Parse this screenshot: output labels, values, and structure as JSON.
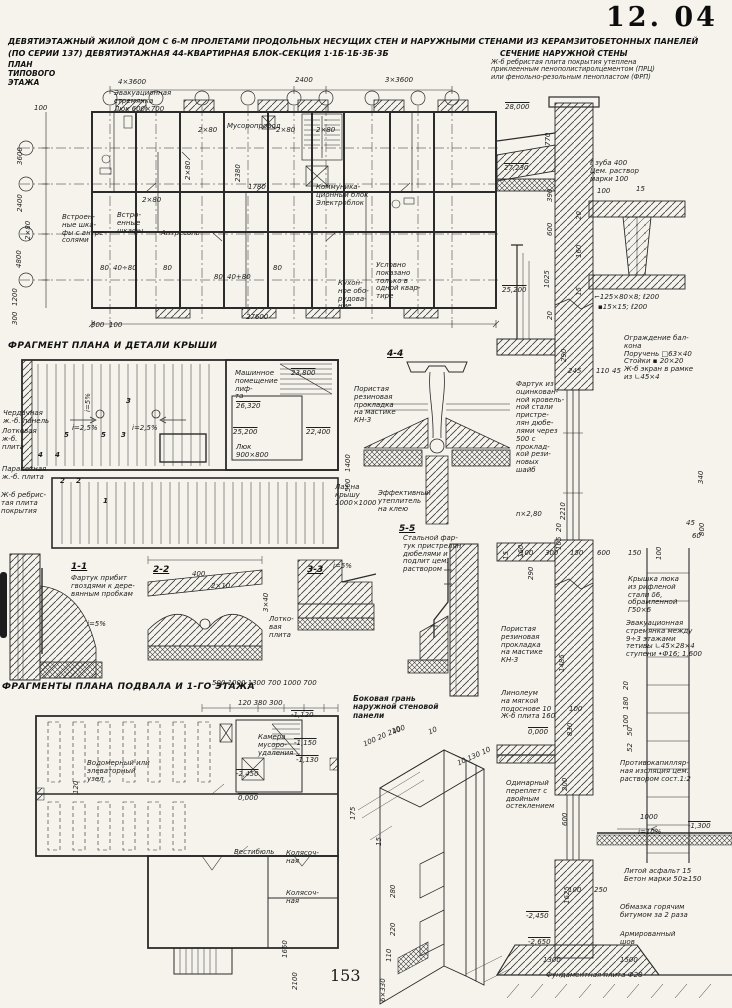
{
  "page": {
    "code": "12. 04",
    "number": "153"
  },
  "title": {
    "line1": "ДЕВЯТИЭТАЖНЫЙ ЖИЛОЙ ДОМ С 6-М ПРОЛЕТАМИ ПРОДОЛЬНЫХ НЕСУЩИХ СТЕН И НАРУЖНЫМИ СТЕНАМИ ИЗ КЕРАМЗИТОБЕТОННЫХ ПАНЕЛЕЙ",
    "line2": "(ПО СЕРИИ 137)   ДЕВЯТИЭТАЖНАЯ 44-КВАРТИРНАЯ БЛОК-СЕКЦИЯ 1·1Б·1Б·3Б·3Б"
  },
  "typical_plan": {
    "heading": "ПЛАН\nТИПОВОГО\nЭТАЖА",
    "labels": {
      "evac": "Эвакуационная\nстремянка\nЛюк 600×700",
      "chute": "Мусоропровод",
      "comm": "Коммуника-\nционный блок\nЭлектроблок",
      "wardrobe_mezz": "Встроен-\nные шка-\nфы с антре-\nсолями",
      "wardrobe": "Встро-\nенные\nшкафы",
      "mezzanine": "Антресоль",
      "kitchen": "Кухон-\nное обо-\nрудова-\nние",
      "note": "Условно\nпоказано\nтолько в\nодной квар-\nтире"
    },
    "dims": {
      "bay1": "4×3600",
      "bay2": "2400",
      "bay3": "3×3600",
      "total": "27600",
      "v3600": "3600",
      "v2400": "2400",
      "v4800": "4800",
      "v1200": "1200",
      "v300": "300",
      "w2x80": "2×80",
      "w80": "80",
      "w4080a": "40÷80",
      "w4080b": "40+80",
      "d2380": "2380",
      "d1780": "1780",
      "d300": "300",
      "d100": "100"
    }
  },
  "roof": {
    "heading": "ФРАГМЕНТ ПЛАНА И ДЕТАЛИ КРЫШИ",
    "labels": {
      "attic_panel": "Чердачная\nж.-б. панель",
      "tray_slab": "Лотковая\nж-б.\nплита",
      "parapet": "Парапетная\nж.-б. плита",
      "ribbed": "Ж-б ребрис-\nтая плита\nпокрытия",
      "machine_room": "Машинное\nпомещение\nлиф-\nта",
      "hatch": "Люк\n900×800",
      "roof_access": "Лаз на\nкрышу\n1000×1000",
      "insulation": "Эффективный\nутеплитель\nна клею"
    },
    "elevations": {
      "e1": "23,800",
      "e2": "26,320",
      "e3": "25,200",
      "e4": "22,400"
    },
    "slopes": {
      "s25": "i=2,5%",
      "s5": "i=5%"
    },
    "dims": {
      "d1400": "1400",
      "d500": "500"
    },
    "marks": {
      "m1": "1",
      "m2": "2",
      "m3": "3",
      "m4": "4",
      "m5": "5"
    }
  },
  "details": {
    "s44": {
      "title": "4-4",
      "gasket": "Пористая\nрезиновая\nпрокладка\nна мастике\nКН-3"
    },
    "s55": {
      "title": "5-5",
      "apron": "Стальной фар-\nтук пристрелян\nдюбелями и\nподлит цем.\nраствором"
    },
    "s11": {
      "title": "1-1",
      "note": "Фартук прибит\nгвоздями к дере-\nвянным пробкам",
      "slope": "i=5%"
    },
    "s22": {
      "title": "2-2",
      "d400": "400",
      "d2x10": "2×10",
      "d3x40": "3×40",
      "tray": "Лотко-\nвая\nплита"
    },
    "s33": {
      "title": "3-3",
      "slope": "i=5%"
    }
  },
  "basement": {
    "heading": "ФРАГМЕНТЫ ПЛАНА ПОДВАЛА И 1-ГО ЭТАЖА",
    "labels": {
      "water": "Водомерный или\nэлеваторный\nузел",
      "refuse": "Камера\nмусоро-\nудаления",
      "lobby": "Вестибюль",
      "pram1": "Колясоч-\nная",
      "pram2": "Колясоч-\nная"
    },
    "dims": {
      "row1": "500   1000    1300    700  1000  700",
      "row2": "120    380   300",
      "v120": "120",
      "d1650": "1650",
      "d2100": "2100"
    },
    "elevations": {
      "e1": "-1,120",
      "e2": "-1,150",
      "e3": "-1,130",
      "e4": "-2,450",
      "e5": "0,000"
    }
  },
  "panel": {
    "heading": "Боковая грань\nнаружной стеновой\nпанели",
    "dims": {
      "d400": "400",
      "row": "100  20 210",
      "d10": "10",
      "row2": "10 130 10",
      "d175": "175",
      "d15": "15",
      "d280": "280",
      "d220": "220",
      "d110": "110",
      "d6x330": "6×330"
    }
  },
  "wall_section": {
    "heading": "СЕЧЕНИЕ НАРУЖНОЙ СТЕНЫ",
    "note": "Ж-б ребристая плита покрытия утеплена\nприклеенным пенополистиролцементом (ПРЦ)\nили фенольно-резольным пенопластом (ФРП)",
    "labels": {
      "tooth": "ℓ зуба 400\nЦем. раствор\nмарки 100",
      "angle1": "⌐125×80×8; ℓ200",
      "angle2": "▪15×15; ℓ200",
      "balcony": "Ограждение бал-\nкона\nПоручень □63×40\nСтойки ▪ 20×20\nЖ-б экран в рамке\nиз ∟45×4",
      "apron": "Фартук из\nоцинкован-\nной кровель-\nной стали\nпристре-\nлян дюбе-\nлями через\n500 с\nпроклад-\nкой рези-\nновых\nшайб",
      "hatch_cover": "Крышка люка\nиз рифленой\nстали δ6,\nобрамленной\nГ50×6",
      "ladder": "Эвакуационная\nстремянка между\n9÷3 этажами\nтетивы ∟45×28×4\nступени •Ф16; 1,600",
      "gasket": "Пористая\nрезиновая\nпрокладка\nна мастике\nКН-3",
      "lino": "Линолеум\nна мягкой\nподоснове 10\nЖ-б плита 160",
      "anticap": "Противокапилляр-\nная изоляция цем.\nраствором сост.1:2",
      "glazing": "Одинарный\nпереплет с\nдвойным\nостеклением",
      "asphalt": "Литой асфальт 15\nБетон марки 50≥150",
      "bitumen": "Обмазка горячим\nбитумом за 2 раза",
      "seam": "Армированный\nшов",
      "foundation": "Фундаментная плита Ф28",
      "slope": "i=10%",
      "n_floors": "n×2,80"
    },
    "elevations": {
      "e28": "28,000",
      "e2723": "27,230",
      "e252": "25,200",
      "e0": "0,000",
      "em13": "-1,300",
      "em245": "-2,450",
      "em265": "-2,650"
    },
    "dims": {
      "d770": "770",
      "d390": "390",
      "d600": "600",
      "d1025": "1025",
      "d20": "20",
      "d100": "100",
      "d15": "15",
      "d160": "160",
      "d245": "245",
      "d110": "110",
      "d45": "45",
      "d290": "290",
      "d2210": "2210",
      "d105": "105",
      "d340": "340",
      "d800": "800",
      "d60": "60",
      "d300": "300",
      "d150": "150",
      "d1485": "1485",
      "d180": "180",
      "d830": "830",
      "d200": "200",
      "d1000": "1000",
      "d1625": "1625",
      "d250": "250",
      "d1300": "1300",
      "d1500": "1500",
      "d50": "50",
      "d52": "52"
    }
  }
}
